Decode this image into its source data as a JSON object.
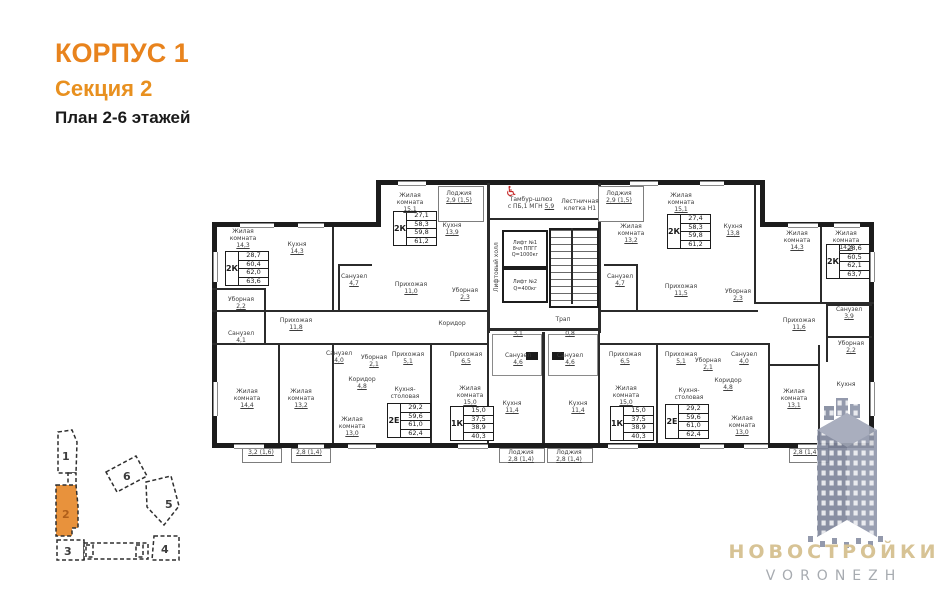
{
  "header": {
    "building": "КОРПУС 1",
    "section": "Секция 2",
    "plan": "План 2-6 этажей"
  },
  "plan": {
    "apartments": [
      {
        "type": "2К",
        "values": [
          "28,7",
          "60,4",
          "62,0",
          "63,6"
        ]
      },
      {
        "type": "2К",
        "values": [
          "27,1",
          "58,3",
          "59,8",
          "61,2"
        ]
      },
      {
        "type": "2К",
        "values": [
          "27,4",
          "58,3",
          "59,8",
          "61,2"
        ]
      },
      {
        "type": "2К",
        "values": [
          "28,6",
          "60,5",
          "62,1",
          "63,7"
        ]
      },
      {
        "type": "2Е",
        "values": [
          "29,2",
          "59,6",
          "61,0",
          "62,4"
        ]
      },
      {
        "type": "1К",
        "values": [
          "15,0",
          "37,5",
          "38,9",
          "40,3"
        ]
      },
      {
        "type": "1К",
        "values": [
          "15,0",
          "37,5",
          "38,9",
          "40,3"
        ]
      },
      {
        "type": "2Е",
        "values": [
          "29,2",
          "59,6",
          "61,0",
          "62,4"
        ]
      }
    ],
    "rooms": [
      {
        "label": "Жилая комната",
        "area": "14,3"
      },
      {
        "label": "Кухня",
        "area": "14,3"
      },
      {
        "label": "Уборная",
        "area": "2,2"
      },
      {
        "label": "Санузел",
        "area": "4,1"
      },
      {
        "label": "Прихожая",
        "area": "11,8"
      },
      {
        "label": "Жилая комната",
        "area": "15,1"
      },
      {
        "label": "Кухня",
        "area": "13,9"
      },
      {
        "label": "Санузел",
        "area": "4,7"
      },
      {
        "label": "Прихожая",
        "area": "11,0"
      },
      {
        "label": "Уборная",
        "area": "2,3"
      },
      {
        "label": "Лоджия",
        "area": "2,9 (1,5)"
      },
      {
        "label": "Жилая комната",
        "area": "13,2"
      },
      {
        "label": "Жилая комната",
        "area": "15,1"
      },
      {
        "label": "Кухня",
        "area": "13,8"
      },
      {
        "label": "Санузел",
        "area": "4,7"
      },
      {
        "label": "Прихожая",
        "area": "11,5"
      },
      {
        "label": "Уборная",
        "area": "2,3"
      },
      {
        "label": "Лоджия",
        "area": "2,9 (1,5)"
      },
      {
        "label": "Жилая комната",
        "area": "14,3"
      },
      {
        "label": "Жилая комната",
        "area": "14,3"
      },
      {
        "label": "Прихожая",
        "area": "11,6"
      },
      {
        "label": "Санузел",
        "area": "3,9"
      },
      {
        "label": "Уборная",
        "area": "2,2"
      },
      {
        "label": "Кухня",
        "area": ""
      },
      {
        "label": "Жилая комната",
        "area": "13,1"
      },
      {
        "label": "",
        "area": "2,8 (1,4)"
      },
      {
        "label": "Коридор",
        "area": ""
      },
      {
        "label": "Жилая комната",
        "area": "14,4"
      },
      {
        "label": "Жилая комната",
        "area": "13,2"
      },
      {
        "label": "",
        "area": "3,2 (1,6)"
      },
      {
        "label": "",
        "area": "2,8 (1,4)"
      },
      {
        "label": "Санузел",
        "area": "4,0"
      },
      {
        "label": "Уборная",
        "area": "2,1"
      },
      {
        "label": "Коридор",
        "area": "4,8"
      },
      {
        "label": "Прихожая",
        "area": "5,1"
      },
      {
        "label": "Кухня-столовая",
        "area": ""
      },
      {
        "label": "Жилая комната",
        "area": "13,0"
      },
      {
        "label": "Прихожая",
        "area": "6,5"
      },
      {
        "label": "Жилая комната",
        "area": "15,0"
      },
      {
        "label": "Кухня",
        "area": "11,4"
      },
      {
        "label": "Санузел",
        "area": "4,6"
      },
      {
        "label": "Лоджия",
        "area": "2,8 (1,4)"
      },
      {
        "label": "",
        "area": "3,1"
      },
      {
        "label": "Санузел",
        "area": "4,6"
      },
      {
        "label": "Прихожая",
        "area": "6,5"
      },
      {
        "label": "Жилая комната",
        "area": "15,0"
      },
      {
        "label": "Кухня",
        "area": "11,4"
      },
      {
        "label": "Лоджия",
        "area": "2,8 (1,4)"
      },
      {
        "label": "",
        "area": "0,8"
      },
      {
        "label": "Прихожая",
        "area": "5,1"
      },
      {
        "label": "Уборная",
        "area": "2,1"
      },
      {
        "label": "Санузел",
        "area": "4,0"
      },
      {
        "label": "Коридор",
        "area": "4,8"
      },
      {
        "label": "Кухня-столовая",
        "area": ""
      },
      {
        "label": "Жилая комната",
        "area": "13,0"
      }
    ],
    "core": {
      "tambour_line1": "Тамбур-шлюз",
      "tambour_line2": "с ПБ,1 МГН",
      "tambour_area": "5,9",
      "stairwell_line1": "Лестничная",
      "stairwell_line2": "клетка Н1",
      "lift_hall": "Лифтовый холл",
      "lift1_name": "Лифт №1",
      "lift1_spec": "8чл ППГГ",
      "lift1_load": "Q=1000кг",
      "lift2_name": "Лифт №2",
      "lift2_load": "Q=400кг",
      "drain": "Трап"
    }
  },
  "minimap": {
    "sections": [
      {
        "label": "1"
      },
      {
        "label": "2"
      },
      {
        "label": "3"
      },
      {
        "label": "4"
      },
      {
        "label": "5"
      },
      {
        "label": "6"
      }
    ],
    "highlighted": "2"
  },
  "logo": {
    "title": "НОВОСТРОЙКИ",
    "subtitle": "VORONEZH"
  },
  "colors": {
    "accent_orange": "#e8831d",
    "minimap_orange": "#e8923c",
    "logo_gold": "#d7c395",
    "logo_grey": "#a7abb0",
    "watermark_blue": "#8a90a4",
    "icon_red": "#c62828"
  }
}
